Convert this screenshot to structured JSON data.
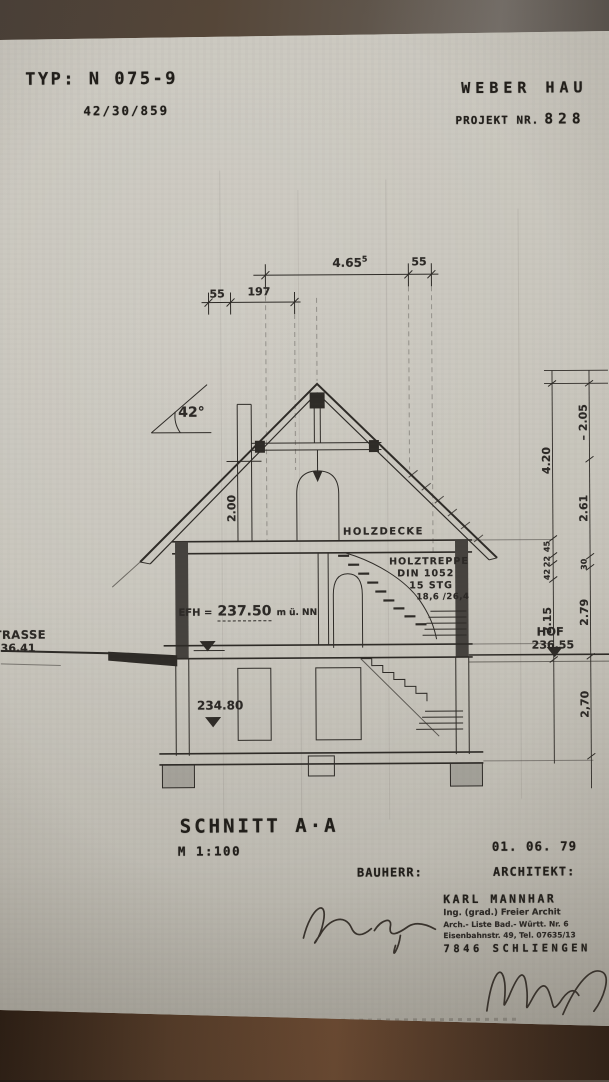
{
  "header": {
    "typ": "TYP: N 075-9",
    "code": "42/30/859",
    "company": "WEBER HAU",
    "project_label": "PROJEKT NR.",
    "project_number": "828"
  },
  "top_dims": {
    "d1": "4.65",
    "d1_sup": "5",
    "d2": "55",
    "d3": "55",
    "d4": "197"
  },
  "drawing": {
    "roof_angle": "42°",
    "attic_height": "2.00",
    "ceiling_label": "HOLZDECKE",
    "stair_line1": "HOLZTREPPE",
    "stair_line2": "DIN 1052",
    "stair_line3": "15 STG",
    "stair_line4": "18,6 /26,4",
    "efh_label": "EFH =",
    "efh_value": "237.50",
    "efh_unit": "m ü. NN",
    "basement_level": "234.80",
    "street_label": "TRASSE",
    "street_level": "36.41",
    "yard_label": "HOF",
    "yard_level": "236.55",
    "dims_inner": [
      "4.20",
      "45",
      "22",
      "42",
      "2.15"
    ],
    "dims_outer": [
      "– 2.05",
      "2.61",
      "30",
      "2.79",
      "2,70"
    ]
  },
  "titleblock": {
    "title": "SCHNITT  A·A",
    "scale": "M  1:100",
    "date": "01.  06.  79",
    "client_label": "BAUHERR:",
    "architect_label": "ARCHITEKT:",
    "architect_name": "KARL MANNHAR",
    "architect_line2": "Ing. (grad.) Freier Archit",
    "architect_line3": "Arch.- Liste Bad.- Württ. Nr. 6",
    "architect_line4": "Eisenbahnstr. 49, Tel. 07635/13",
    "architect_city": "7846 SCHLIENGEN"
  },
  "colors": {
    "paper": "#c8c5bc",
    "ink": "#2e2b27",
    "background": "#3b2b20"
  }
}
